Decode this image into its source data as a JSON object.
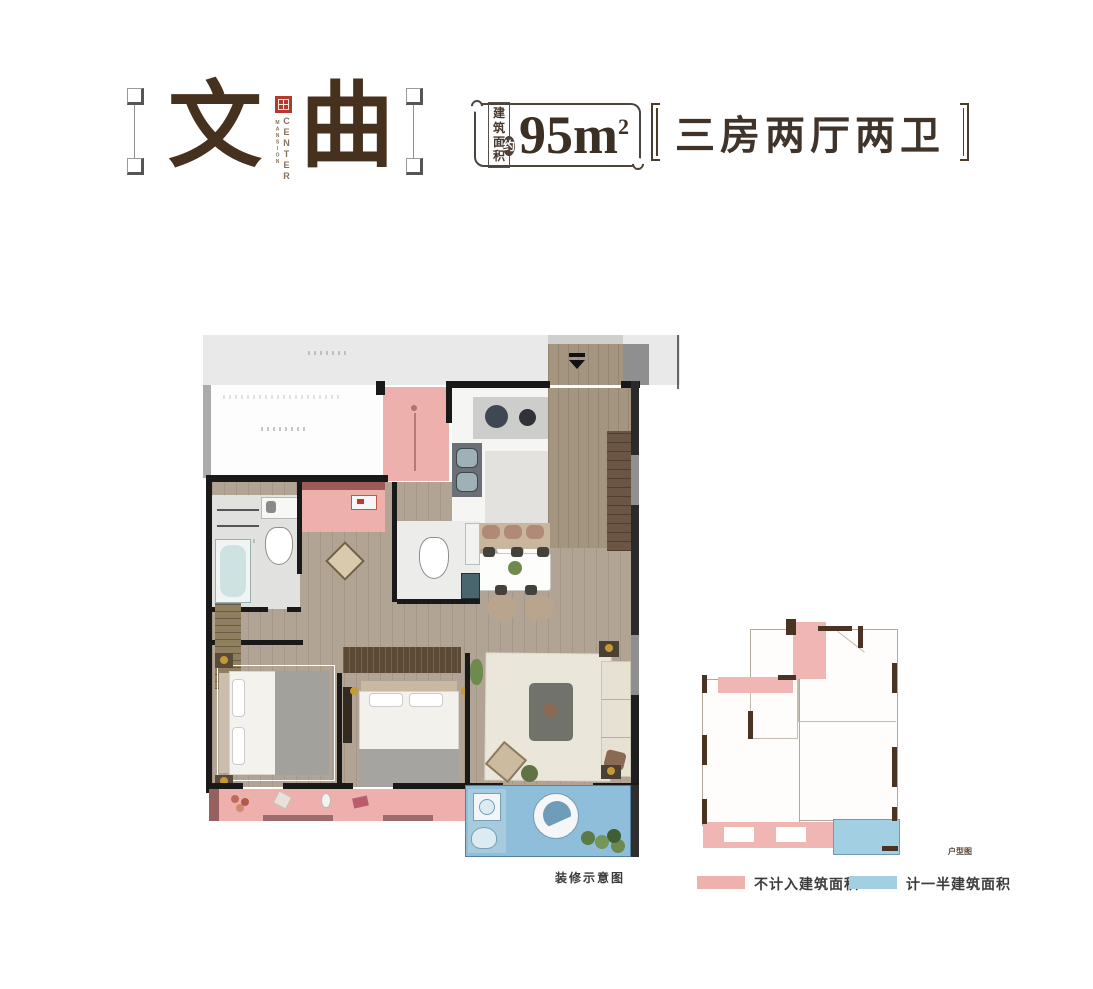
{
  "header": {
    "title": {
      "char1": "文",
      "char2": "曲"
    },
    "brand": {
      "line1": "CENTER",
      "line2": "MANSION"
    },
    "area_badge": {
      "label_top": "建筑",
      "label_bottom": "面积",
      "approx": "约",
      "value": "95m",
      "superscript": "2"
    },
    "unit_type": "三房两厅两卫"
  },
  "plan": {
    "caption": "装修示意图"
  },
  "keyplan": {
    "label": "户型图"
  },
  "legend": {
    "items": [
      {
        "label": "不计入建筑面积",
        "color": "#EFB1AE",
        "swatch_style": "background:#EFB1AE"
      },
      {
        "label": "计一半建筑面积",
        "color": "#A3CFE3",
        "swatch_style": "background:#A3CFE3"
      }
    ]
  },
  "colors": {
    "title_brown": "#46311F",
    "seal_red": "#B23A2C",
    "not_counted_pink": "#EEB0AD",
    "half_counted_blue": "#8FBEDA",
    "wood_floor": "#B1A494",
    "corridor_gray": "#E9E9E9",
    "wall_black": "#191919"
  }
}
